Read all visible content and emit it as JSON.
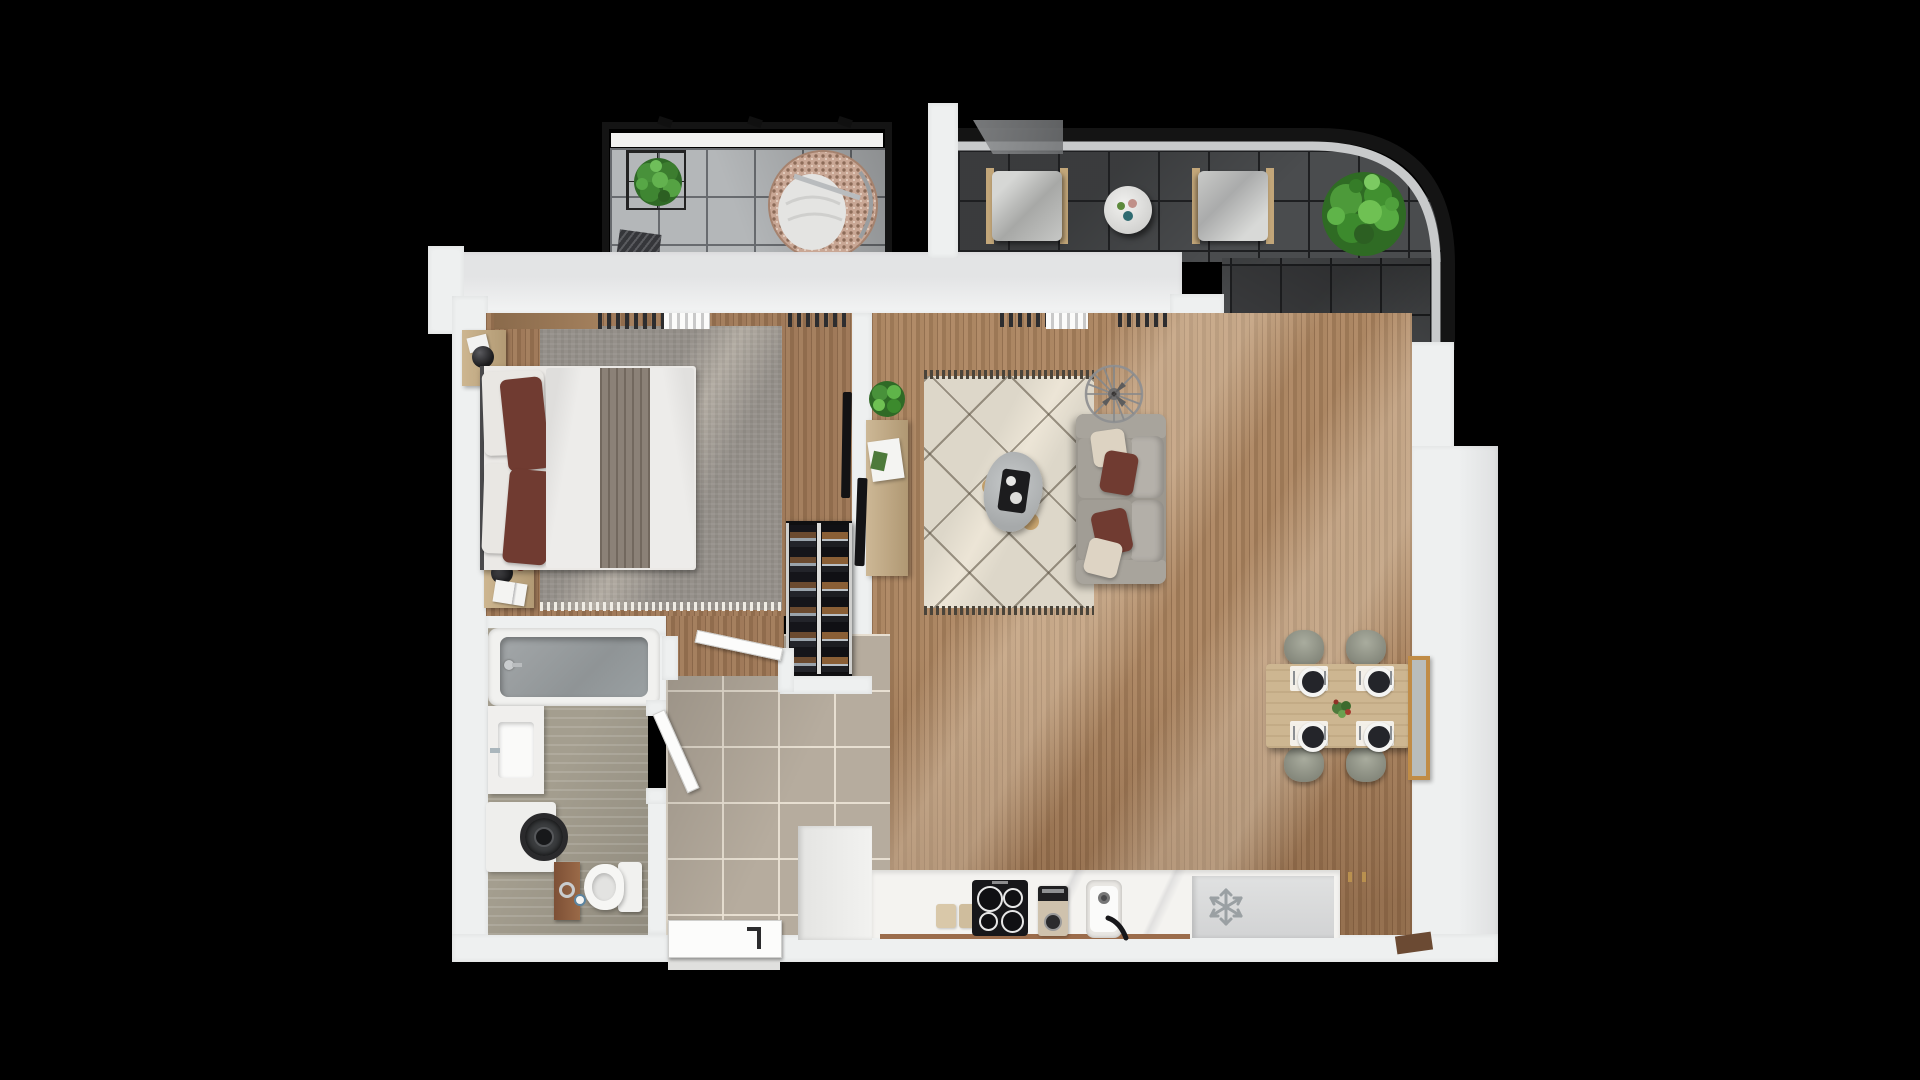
{
  "scene": {
    "type": "3d-apartment-floor-plan-top-view",
    "background_color": "#000000",
    "wall_color": "#eef0f0"
  },
  "palette": {
    "balcony_tile": "#b4b7b9",
    "terrace_tile": "#4a4c4e",
    "hall_tile": "#b6ac9e",
    "bathroom_floor": "#a49e8f",
    "wood_floor": "#a8815d",
    "rug_living": "#ddd7c9",
    "rug_bedroom": "#95908a",
    "sofa_gray": "#9b978f",
    "accent_pillow_maroon": "#703b31",
    "plant_green": "#4d9a3a",
    "counter_white": "#f4f3f0",
    "cooktop_black": "#17171a",
    "railing_black": "#141414"
  },
  "rooms": [
    {
      "name": "balcony",
      "items": [
        "caged-plant",
        "hanging-egg-chair",
        "doormat"
      ]
    },
    {
      "name": "terrace",
      "items": [
        "lounge-chair-left",
        "lounge-chair-right",
        "round-side-table",
        "large-plant",
        "curved-railing"
      ]
    },
    {
      "name": "bedroom",
      "items": [
        "double-bed",
        "nightstand-top",
        "nightstand-bottom",
        "wardrobe-shelf",
        "radiators",
        "wall-tv",
        "wine-rack",
        "area-rug"
      ]
    },
    {
      "name": "living-room",
      "items": [
        "sofa",
        "coffee-table",
        "tv-console",
        "console-plant",
        "ceiling-fan",
        "diamond-rug",
        "wall-tv"
      ]
    },
    {
      "name": "dining-area",
      "items": [
        "dining-table",
        "four-chairs",
        "four-place-settings",
        "centerpiece",
        "wall-mirror"
      ]
    },
    {
      "name": "kitchen",
      "items": [
        "counter",
        "cutting-boards",
        "induction-cooktop",
        "coffee-machine",
        "sink",
        "fridge-freezer",
        "tall-cabinet"
      ]
    },
    {
      "name": "bathroom",
      "items": [
        "bathtub",
        "vanity-sink",
        "washing-machine",
        "wooden-shelf",
        "toilet"
      ]
    },
    {
      "name": "hallway",
      "items": [
        "entrance-door",
        "bedroom-door",
        "bathroom-door"
      ]
    }
  ]
}
